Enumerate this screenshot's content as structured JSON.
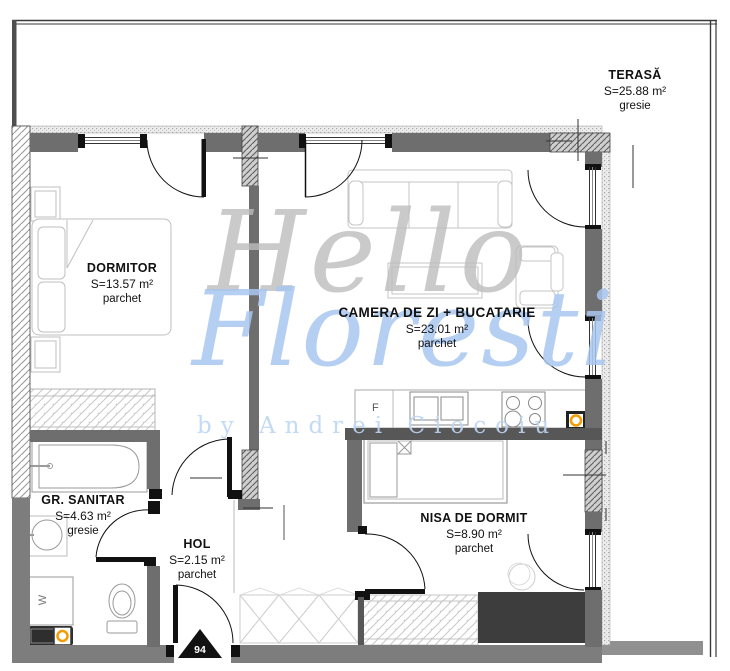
{
  "plan": {
    "rooms": [
      {
        "name": "DORMITOR",
        "area": "S=13.57 m²",
        "floor": "parchet"
      },
      {
        "name": "CAMERA DE ZI + BUCATARIE",
        "area": "S=23.01 m²",
        "floor": "parchet"
      },
      {
        "name": "NISA DE DORMIT",
        "area": "S=8.90 m²",
        "floor": "parchet"
      },
      {
        "name": "GR. SANITAR",
        "area": "S=4.63 m²",
        "floor": "gresie"
      },
      {
        "name": "HOL",
        "area": "S=2.15 m²",
        "floor": "parchet"
      },
      {
        "name": "TERASĂ",
        "area": "S=25.88 m²",
        "floor": "gresie"
      }
    ],
    "entrance_number": "94",
    "fixture_labels": {
      "fridge": "F",
      "washer": "W"
    },
    "watermark": {
      "line1": "Hello",
      "line2": "Floresti",
      "byline": "by Andrei Ciocoiu"
    },
    "colors": {
      "wall": "#6e6e6e",
      "wall_dark": "#575757",
      "wall_exterior": "#7d7d7d",
      "accent_orange": "#f59b00",
      "watermark_gray": "#bdbdbd",
      "watermark_blue": "#a9c7f0",
      "furniture_line": "#c0c0c0"
    }
  }
}
